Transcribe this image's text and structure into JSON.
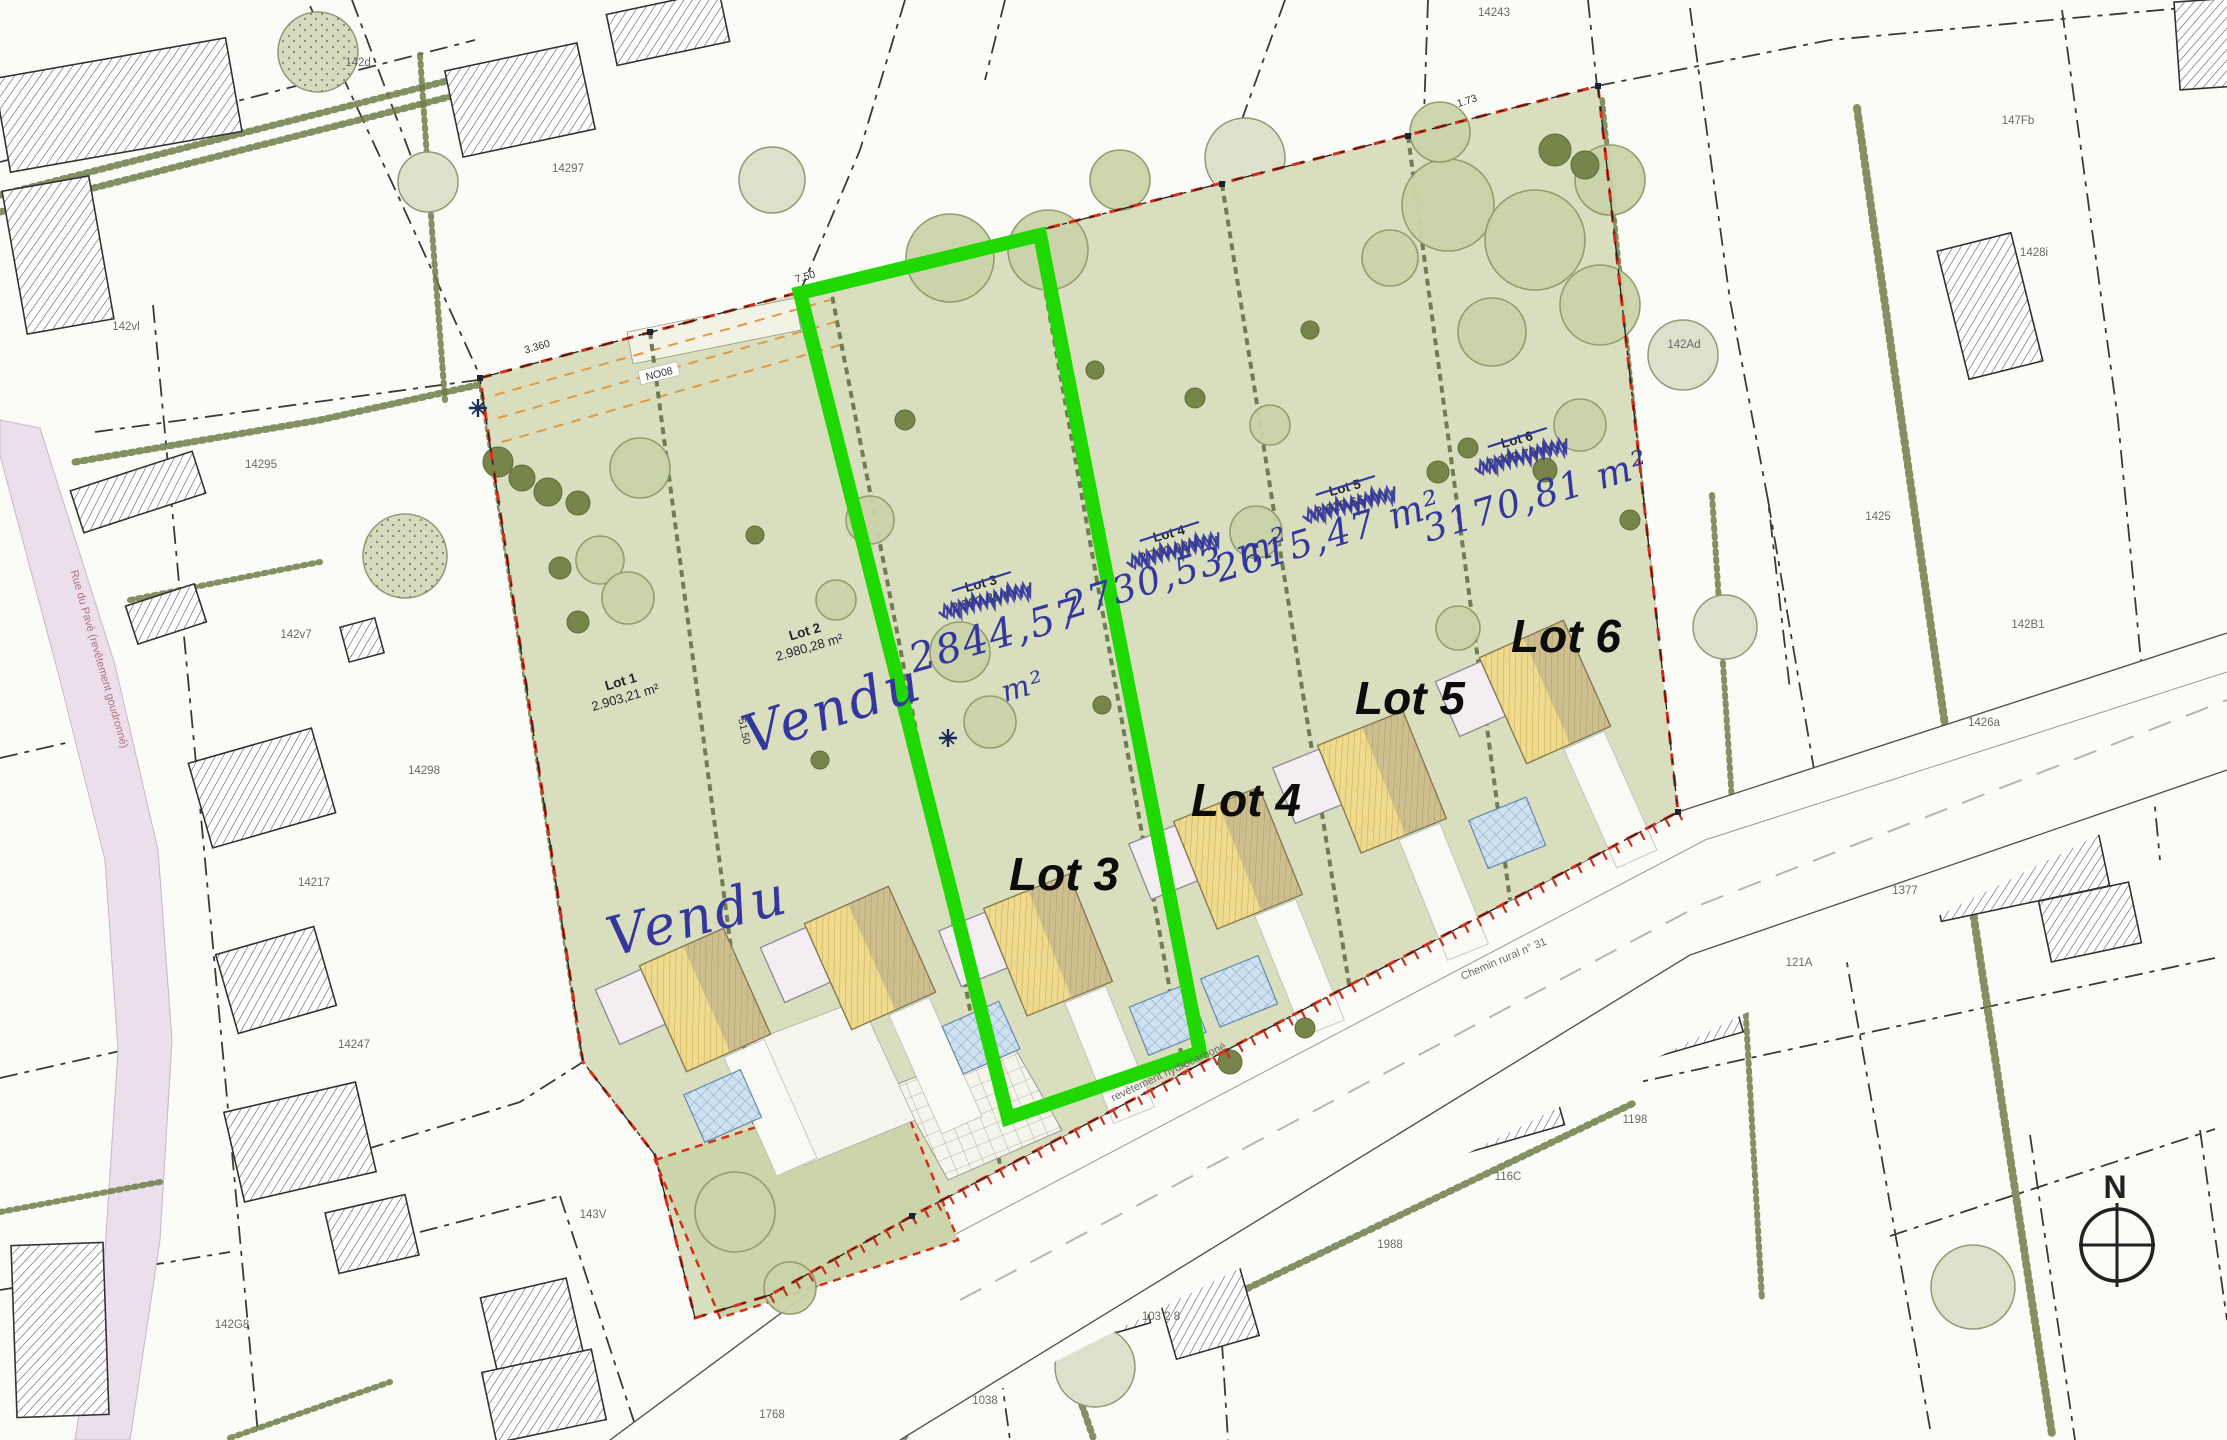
{
  "map": {
    "compass_label": "N",
    "colors": {
      "development_fill": "#d9debf",
      "garden_fill": "#ccd4a9",
      "highlight_green": "#1fd800",
      "boundary_red": "#d23018",
      "handwriting_blue": "#34379b",
      "roof_yellow": "#eeda8e",
      "terrace_blue": "#cfe0ef",
      "road_pink": "#ecdfec",
      "tree_fill": "#cbd3a9",
      "bush_fill": "#78854a"
    },
    "development": {
      "lots": [
        {
          "name": "Lot 1",
          "printed_area": "2.903,21 m²",
          "crossed_out": false,
          "handwritten_area": "",
          "note": "Vendu"
        },
        {
          "name": "Lot 2",
          "printed_area": "2.980,28 m²",
          "crossed_out": false,
          "handwritten_area": "",
          "note": "Vendu"
        },
        {
          "name": "Lot 3",
          "printed_area": "2.592,31 m²",
          "crossed_out": true,
          "handwritten_area": "2844,57 m²",
          "big_label": "Lot 3",
          "highlighted": true
        },
        {
          "name": "Lot 4",
          "printed_area": "2.700,98 m²",
          "crossed_out": true,
          "handwritten_area": "2730,53 m²",
          "big_label": "Lot 4",
          "highlighted": false
        },
        {
          "name": "Lot 5",
          "printed_area": "2.625,66 m²",
          "crossed_out": true,
          "handwritten_area": "2615,47 m²",
          "big_label": "Lot 5",
          "highlighted": false
        },
        {
          "name": "Lot 6",
          "printed_area": "2.905,70 m²",
          "crossed_out": true,
          "handwritten_area": "3170,81 m²",
          "big_label": "Lot 6",
          "highlighted": false
        }
      ]
    },
    "printed_labels": [
      {
        "lot": 0,
        "x": 622,
        "y": 686,
        "rot": -16
      },
      {
        "lot": 1,
        "x": 806,
        "y": 636,
        "rot": -16
      },
      {
        "lot": 2,
        "x": 982,
        "y": 588,
        "rot": -15
      },
      {
        "lot": 3,
        "x": 1170,
        "y": 538,
        "rot": -15
      },
      {
        "lot": 4,
        "x": 1346,
        "y": 492,
        "rot": -15
      },
      {
        "lot": 5,
        "x": 1518,
        "y": 444,
        "rot": -15
      }
    ],
    "big_labels": [
      {
        "lot": 2,
        "x": 1064,
        "y": 890
      },
      {
        "lot": 3,
        "x": 1246,
        "y": 816
      },
      {
        "lot": 4,
        "x": 1410,
        "y": 714
      },
      {
        "lot": 5,
        "x": 1566,
        "y": 652
      }
    ],
    "handwritten_areas": [
      {
        "text": "2844,57",
        "x": 1000,
        "y": 648,
        "rot": -16,
        "size": 40
      },
      {
        "text": "m²",
        "x": 1026,
        "y": 696,
        "rot": -16,
        "size": 30
      },
      {
        "text": "2730,53 m²",
        "x": 1180,
        "y": 585,
        "rot": -17,
        "size": 37
      },
      {
        "text": "2615,47 m²",
        "x": 1332,
        "y": 548,
        "rot": -17,
        "size": 37
      },
      {
        "text": "3170,81 m²",
        "x": 1540,
        "y": 508,
        "rot": -17,
        "size": 37
      }
    ],
    "sold_notes": [
      {
        "text": "Vendu",
        "x": 838,
        "y": 726,
        "rot": -18
      },
      {
        "text": "Vendu",
        "x": 702,
        "y": 934,
        "rot": -14
      }
    ],
    "boundary_labels": [
      {
        "text": "3.360",
        "x": 538,
        "y": 350,
        "rot": -16
      },
      {
        "text": "7.50",
        "x": 806,
        "y": 280,
        "rot": -16
      },
      {
        "text": "1.73",
        "x": 1468,
        "y": 104,
        "rot": -18
      },
      {
        "text": "NO08",
        "x": 660,
        "y": 377,
        "rot": -14
      },
      {
        "text": "51.50",
        "x": 741,
        "y": 732,
        "rot": 78
      }
    ],
    "road_labels": [
      {
        "text": "Chemin rural n° 31",
        "x": 1505,
        "y": 962,
        "rot": -23,
        "color": "#6a6a6a"
      },
      {
        "text": "revêtement hydrocarboné",
        "x": 1170,
        "y": 1075,
        "rot": -25,
        "color": "#6a6a6a"
      },
      {
        "text": "Rue du Pavé (revêtement goudronné)",
        "x": 96,
        "y": 660,
        "rot": 74,
        "color": "#b07080"
      }
    ],
    "parcel_labels": [
      {
        "text": "142d",
        "x": 358,
        "y": 66
      },
      {
        "text": "14243",
        "x": 1494,
        "y": 16
      },
      {
        "text": "14297",
        "x": 568,
        "y": 172
      },
      {
        "text": "147Fb",
        "x": 2018,
        "y": 124
      },
      {
        "text": "1428i",
        "x": 2034,
        "y": 256
      },
      {
        "text": "142Ad",
        "x": 1684,
        "y": 348
      },
      {
        "text": "142vl",
        "x": 126,
        "y": 330
      },
      {
        "text": "14295",
        "x": 261,
        "y": 468
      },
      {
        "text": "1425",
        "x": 1878,
        "y": 520
      },
      {
        "text": "142B1",
        "x": 2028,
        "y": 628
      },
      {
        "text": "142v7",
        "x": 296,
        "y": 638
      },
      {
        "text": "1426a",
        "x": 1984,
        "y": 726
      },
      {
        "text": "14298",
        "x": 424,
        "y": 774
      },
      {
        "text": "14217",
        "x": 314,
        "y": 886
      },
      {
        "text": "1377",
        "x": 1905,
        "y": 894
      },
      {
        "text": "121A",
        "x": 1799,
        "y": 966
      },
      {
        "text": "14247",
        "x": 354,
        "y": 1048
      },
      {
        "text": "1198",
        "x": 1635,
        "y": 1123
      },
      {
        "text": "116C",
        "x": 1508,
        "y": 1180
      },
      {
        "text": "1988",
        "x": 1390,
        "y": 1248
      },
      {
        "text": "143V",
        "x": 593,
        "y": 1218
      },
      {
        "text": "103 2 8",
        "x": 1161,
        "y": 1320
      },
      {
        "text": "142G8",
        "x": 232,
        "y": 1328
      },
      {
        "text": "1038",
        "x": 985,
        "y": 1404
      },
      {
        "text": "1768",
        "x": 772,
        "y": 1418
      }
    ]
  }
}
